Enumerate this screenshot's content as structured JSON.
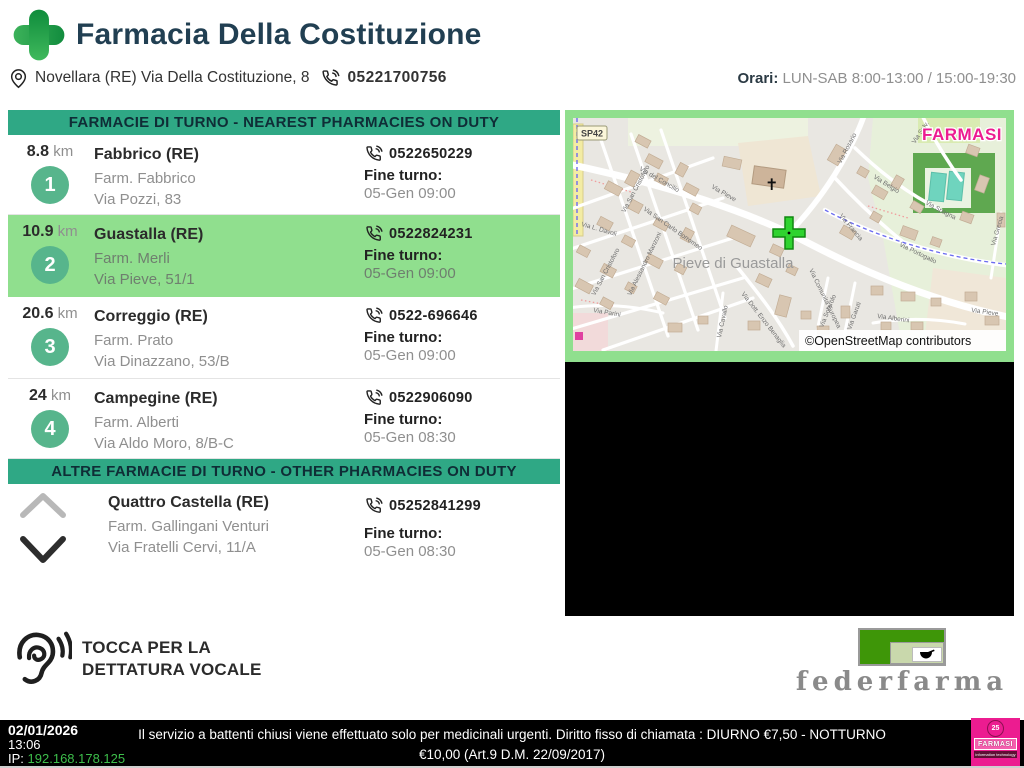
{
  "header": {
    "title": "Farmacia Della Costituzione",
    "address": "Novellara (RE) Via Della Costituzione, 8",
    "phone": "05221700756",
    "orari_label": "Orari:",
    "orari_value": "LUN-SAB 8:00-13:00 / 15:00-19:30"
  },
  "nearest": {
    "banner": "FARMACIE DI TURNO - NEAREST PHARMACIES ON DUTY",
    "items": [
      {
        "distance": "8.8",
        "unit": "km",
        "number": "1",
        "city": "Fabbrico (RE)",
        "name": "Farm. Fabbrico",
        "street": "Via Pozzi, 83",
        "phone": "0522650229",
        "fine_label": "Fine turno:",
        "fine_value": "05-Gen 09:00"
      },
      {
        "distance": "10.9",
        "unit": "km",
        "number": "2",
        "city": "Guastalla (RE)",
        "name": "Farm. Merli",
        "street": "Via Pieve, 51/1",
        "phone": "0522824231",
        "fine_label": "Fine turno:",
        "fine_value": "05-Gen 09:00"
      },
      {
        "distance": "20.6",
        "unit": "km",
        "number": "3",
        "city": "Correggio (RE)",
        "name": "Farm. Prato",
        "street": "Via Dinazzano, 53/B",
        "phone": "0522-696646",
        "fine_label": "Fine turno:",
        "fine_value": "05-Gen 09:00"
      },
      {
        "distance": "24",
        "unit": "km",
        "number": "4",
        "city": "Campegine (RE)",
        "name": "Farm. Alberti",
        "street": "Via Aldo Moro, 8/B-C",
        "phone": "0522906090",
        "fine_label": "Fine turno:",
        "fine_value": "05-Gen 08:30"
      }
    ]
  },
  "other": {
    "banner": "ALTRE FARMACIE DI TURNO - OTHER PHARMACIES ON DUTY",
    "item": {
      "city": "Quattro Castella (RE)",
      "name": "Farm. Gallingani Venturi",
      "street": "Via Fratelli Cervi, 11/A",
      "phone": "05252841299",
      "fine_label": "Fine turno:",
      "fine_value": "05-Gen 08:30"
    }
  },
  "map": {
    "route_badge": "SP42",
    "brand": "FARMASI",
    "place_label": "Pieve di Guastalla",
    "church_symbol": "✝",
    "attribution": "©OpenStreetMap contributors",
    "streets": [
      {
        "text": "Via San Cristoforo",
        "x": 52,
        "y": 95,
        "rot": -62
      },
      {
        "text": "Via San Cristoforo",
        "x": 22,
        "y": 178,
        "rot": -62
      },
      {
        "text": "Via del Concilio",
        "x": 66,
        "y": 52,
        "rot": 30
      },
      {
        "text": "Via San Carlo Borromeo",
        "x": 70,
        "y": 92,
        "rot": 35
      },
      {
        "text": "Via L. Davoli",
        "x": 8,
        "y": 108,
        "rot": 16
      },
      {
        "text": "Via Alessandro Manzoni",
        "x": 58,
        "y": 178,
        "rot": -64
      },
      {
        "text": "Via Pieve",
        "x": 138,
        "y": 70,
        "rot": 30
      },
      {
        "text": "Via Rosario",
        "x": 268,
        "y": 46,
        "rot": -62
      },
      {
        "text": "Via Belgio",
        "x": 300,
        "y": 60,
        "rot": 32
      },
      {
        "text": "Via Francia",
        "x": 266,
        "y": 98,
        "rot": 50
      },
      {
        "text": "Via Spagna",
        "x": 352,
        "y": 86,
        "rot": 28
      },
      {
        "text": "Via Salv.",
        "x": 342,
        "y": 26,
        "rot": -56
      },
      {
        "text": "Via Comunità Europea",
        "x": 236,
        "y": 152,
        "rot": 64
      },
      {
        "text": "Via Portogallo",
        "x": 326,
        "y": 128,
        "rot": 26
      },
      {
        "text": "Via Grecia",
        "x": 422,
        "y": 128,
        "rot": -74
      },
      {
        "text": "Via Parini",
        "x": 20,
        "y": 194,
        "rot": 10
      },
      {
        "text": "Via Dott. Enzo Benaglia",
        "x": 168,
        "y": 176,
        "rot": 52
      },
      {
        "text": "Via Cavallo",
        "x": 148,
        "y": 220,
        "rot": -78
      },
      {
        "text": "Via Solarolo",
        "x": 250,
        "y": 210,
        "rot": -68
      },
      {
        "text": "Via Garuti",
        "x": 278,
        "y": 212,
        "rot": -70
      },
      {
        "text": "Via Alberini",
        "x": 304,
        "y": 200,
        "rot": 8
      },
      {
        "text": "Via Pieve",
        "x": 398,
        "y": 194,
        "rot": 8
      }
    ]
  },
  "voice": {
    "line1": "TOCCA PER LA",
    "line2": "DETTATURA VOCALE"
  },
  "federfarma": {
    "wordmark": "federfarma"
  },
  "footer": {
    "date": "02/01/2026",
    "time": "13:06",
    "ip_label": "IP:",
    "ip_value": "192.168.178.125",
    "notice_line1": "Il servizio a battenti chiusi viene effettuato solo per medicinali urgenti. Diritto fisso di chiamata : DIURNO €7,50 - NOTTURNO",
    "notice_line2": "€10,00 (Art.9 D.M. 22/09/2017)",
    "logo_badge": "25",
    "logo_brand": "FARMASI",
    "logo_tagline": "information technology"
  },
  "colors": {
    "accent": "#2FA885",
    "hl": "#90DF8E",
    "badge": "#57B58C",
    "title": "#213F52",
    "pink": "#EC1C90",
    "ipgreen": "#3DBE4B",
    "fedgreen": "#3E9608"
  }
}
